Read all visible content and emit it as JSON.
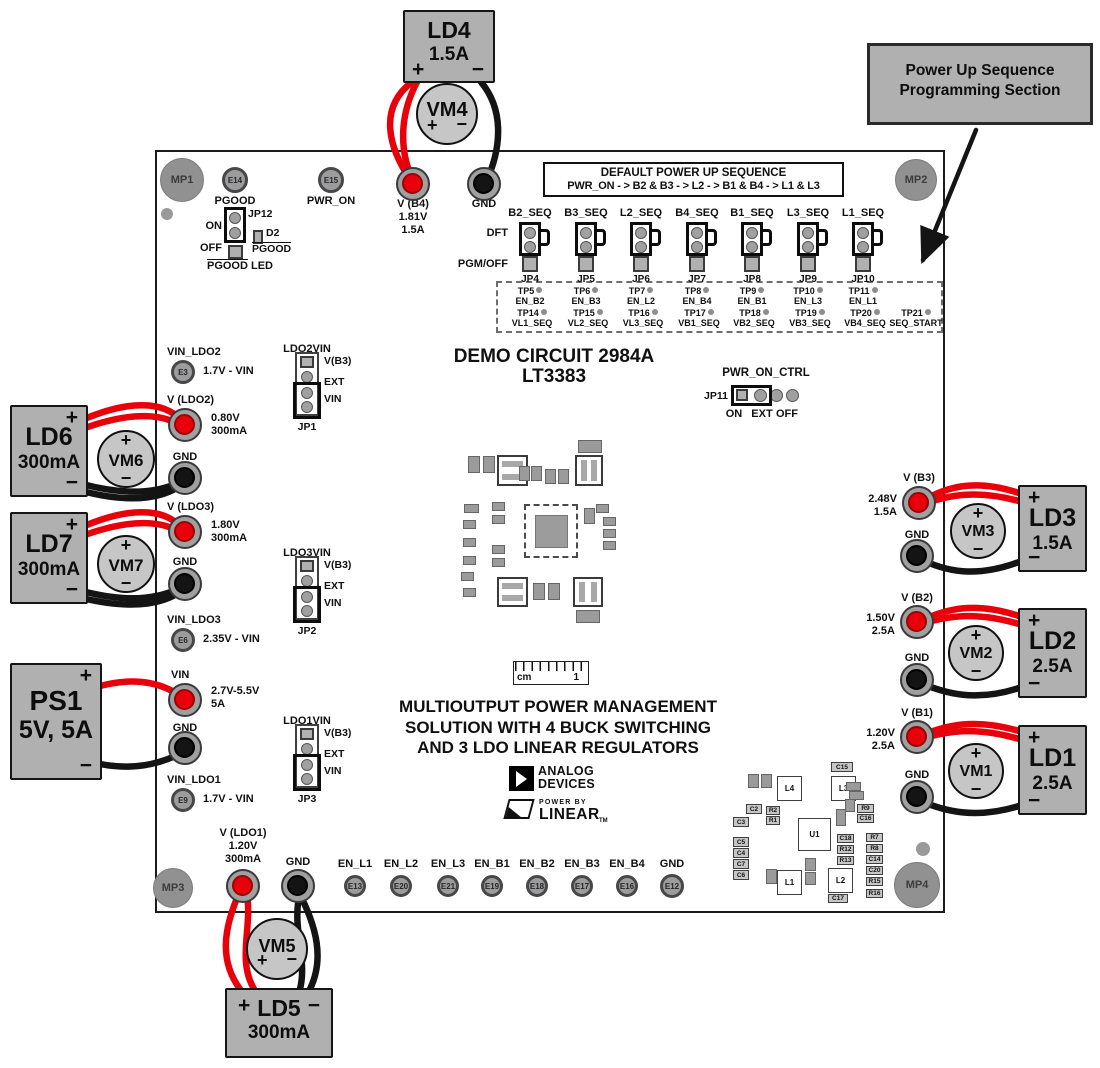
{
  "symbols": {
    "plus": "+",
    "minus": "−"
  },
  "colors": {
    "wire_red": "#e8000b",
    "wire_black": "#141414",
    "box_gray": "#b0b0b0"
  },
  "callout": {
    "line1": "Power Up Sequence",
    "line2": "Programming Section"
  },
  "board": {
    "title_line1": "DEMO CIRCUIT 2984A",
    "title_line2": "LT3383",
    "default_sequence_line1": "DEFAULT POWER UP SEQUENCE",
    "default_sequence_line2": "PWR_ON - > B2 & B3 - > L2 - > B1 & B4 - > L1 & L3",
    "description_line1": "MULTIOUTPUT POWER MANAGEMENT",
    "description_line2": "SOLUTION WITH 4 BUCK SWITCHING",
    "description_line3": "AND 3 LDO LINEAR REGULATORS",
    "ruler_unit": "cm",
    "ruler_mark": "1",
    "logo_adi_line1": "ANALOG",
    "logo_adi_line2": "DEVICES",
    "logo_power_by": "POWER BY",
    "logo_linear": "LINEAR",
    "logo_tm": "TM"
  },
  "pgood": {
    "jp12_id": "JP12",
    "on": "ON",
    "off": "OFF",
    "d2_id": "D2",
    "d2_label": "PGOOD",
    "led_label_main": "PGOOD",
    "led_label_suffix": " LED"
  },
  "power_on_ctrl": {
    "title": "PWR_ON_CTRL",
    "id": "JP11",
    "opt1": "ON",
    "opt2": "EXT",
    "opt3": "OFF"
  },
  "sequence_section": {
    "row_label_top": "DFT",
    "row_label_bottom": "PGM/OFF",
    "jumpers": [
      {
        "signal": "B2_SEQ",
        "id": "JP4"
      },
      {
        "signal": "B3_SEQ",
        "id": "JP5"
      },
      {
        "signal": "L2_SEQ",
        "id": "JP6"
      },
      {
        "signal": "B4_SEQ",
        "id": "JP7"
      },
      {
        "signal": "B1_SEQ",
        "id": "JP8"
      },
      {
        "signal": "L3_SEQ",
        "id": "JP9"
      },
      {
        "signal": "L1_SEQ",
        "id": "JP10"
      }
    ],
    "testpoints_row1": [
      {
        "id": "TP5",
        "signal": "EN_B2"
      },
      {
        "id": "TP6",
        "signal": "EN_B3"
      },
      {
        "id": "TP7",
        "signal": "EN_L2"
      },
      {
        "id": "TP8",
        "signal": "EN_B4"
      },
      {
        "id": "TP9",
        "signal": "EN_B1"
      },
      {
        "id": "TP10",
        "signal": "EN_L3"
      },
      {
        "id": "TP11",
        "signal": "EN_L1"
      }
    ],
    "testpoints_row2": [
      {
        "id": "TP14",
        "signal": "VL1_SEQ"
      },
      {
        "id": "TP15",
        "signal": "VL2_SEQ"
      },
      {
        "id": "TP16",
        "signal": "VL3_SEQ"
      },
      {
        "id": "TP17",
        "signal": "VB1_SEQ"
      },
      {
        "id": "TP18",
        "signal": "VB2_SEQ"
      },
      {
        "id": "TP19",
        "signal": "VB3_SEQ"
      },
      {
        "id": "TP20",
        "signal": "VB4_SEQ"
      },
      {
        "id": "TP21",
        "signal": "SEQ_START"
      }
    ]
  },
  "vin_jumpers": [
    {
      "title": "LDO2VIN",
      "id": "JP1",
      "pin1": "V(B3)",
      "pin2": "EXT",
      "pin3": "VIN"
    },
    {
      "title": "LDO3VIN",
      "id": "JP2",
      "pin1": "V(B3)",
      "pin2": "EXT",
      "pin3": "VIN"
    },
    {
      "title": "LDO1VIN",
      "id": "JP3",
      "pin1": "V(B3)",
      "pin2": "EXT",
      "pin3": "VIN"
    }
  ],
  "terminals": [
    {
      "key": "vb4",
      "name": "V (B4)",
      "values": [
        "1.81V",
        "1.5A"
      ],
      "type": "red"
    },
    {
      "key": "gnd_top",
      "name": "GND",
      "type": "black"
    },
    {
      "key": "vldo2",
      "name": "V (LDO2)",
      "values": [
        "0.80V",
        "300mA"
      ],
      "type": "red"
    },
    {
      "key": "gnd_ldo2",
      "name": "GND",
      "type": "black"
    },
    {
      "key": "vldo3",
      "name": "V (LDO3)",
      "values": [
        "1.80V",
        "300mA"
      ],
      "type": "red"
    },
    {
      "key": "gnd_ldo3",
      "name": "GND",
      "type": "black"
    },
    {
      "key": "vin",
      "name": "VIN",
      "values": [
        "2.7V-5.5V",
        "5A"
      ],
      "type": "red"
    },
    {
      "key": "gnd_vin",
      "name": "GND",
      "type": "black"
    },
    {
      "key": "vb3",
      "name": "V (B3)",
      "values": [
        "2.48V",
        "1.5A"
      ],
      "type": "red"
    },
    {
      "key": "gnd_b3",
      "name": "GND",
      "type": "black"
    },
    {
      "key": "vb2",
      "name": "V (B2)",
      "values": [
        "1.50V",
        "2.5A"
      ],
      "type": "red"
    },
    {
      "key": "gnd_b2",
      "name": "GND",
      "type": "black"
    },
    {
      "key": "vb1",
      "name": "V (B1)",
      "values": [
        "1.20V",
        "2.5A"
      ],
      "type": "red"
    },
    {
      "key": "gnd_b1",
      "name": "GND",
      "type": "black"
    },
    {
      "key": "vldo1",
      "name": "V (LDO1)",
      "values": [
        "1.20V",
        "300mA"
      ],
      "type": "red"
    },
    {
      "key": "gnd_ldo1",
      "name": "GND",
      "type": "black"
    }
  ],
  "turrets": [
    {
      "id": "E14",
      "label": "PGOOD"
    },
    {
      "id": "E15",
      "label": "PWR_ON"
    },
    {
      "id": "E3",
      "label": "VIN_LDO2",
      "value": "1.7V - VIN"
    },
    {
      "id": "E6",
      "label": "VIN_LDO3",
      "value": "2.35V - VIN"
    },
    {
      "id": "E9",
      "label": "VIN_LDO1",
      "value": "1.7V - VIN"
    },
    {
      "id": "E13",
      "label": "EN_L1"
    },
    {
      "id": "E20",
      "label": "EN_L2"
    },
    {
      "id": "E21",
      "label": "EN_L3"
    },
    {
      "id": "E19",
      "label": "EN_B1"
    },
    {
      "id": "E18",
      "label": "EN_B2"
    },
    {
      "id": "E17",
      "label": "EN_B3"
    },
    {
      "id": "E16",
      "label": "EN_B4"
    },
    {
      "id": "E12",
      "label": "GND"
    }
  ],
  "loads": [
    {
      "id": "LD4",
      "rating": "1.5A"
    },
    {
      "id": "LD6",
      "rating": "300mA"
    },
    {
      "id": "LD7",
      "rating": "300mA"
    },
    {
      "id": "PS1",
      "rating": "5V, 5A"
    },
    {
      "id": "LD3",
      "rating": "1.5A"
    },
    {
      "id": "LD2",
      "rating": "2.5A"
    },
    {
      "id": "LD1",
      "rating": "2.5A"
    },
    {
      "id": "LD5",
      "rating": "300mA"
    }
  ],
  "voltmeters": [
    "VM4",
    "VM6",
    "VM7",
    "VM3",
    "VM2",
    "VM1",
    "VM5"
  ],
  "mount_posts": [
    "MP1",
    "MP2",
    "MP3",
    "MP4"
  ],
  "silkscreen_parts": [
    "C15",
    "L4",
    "L3",
    "C2",
    "C3",
    "C5",
    "C4",
    "C7",
    "C6",
    "R2",
    "R1",
    "U1",
    "R9",
    "C16",
    "C18",
    "R12",
    "R13",
    "R7",
    "R8",
    "C14",
    "C20",
    "R15",
    "R16",
    "L1",
    "L2",
    "C17"
  ]
}
